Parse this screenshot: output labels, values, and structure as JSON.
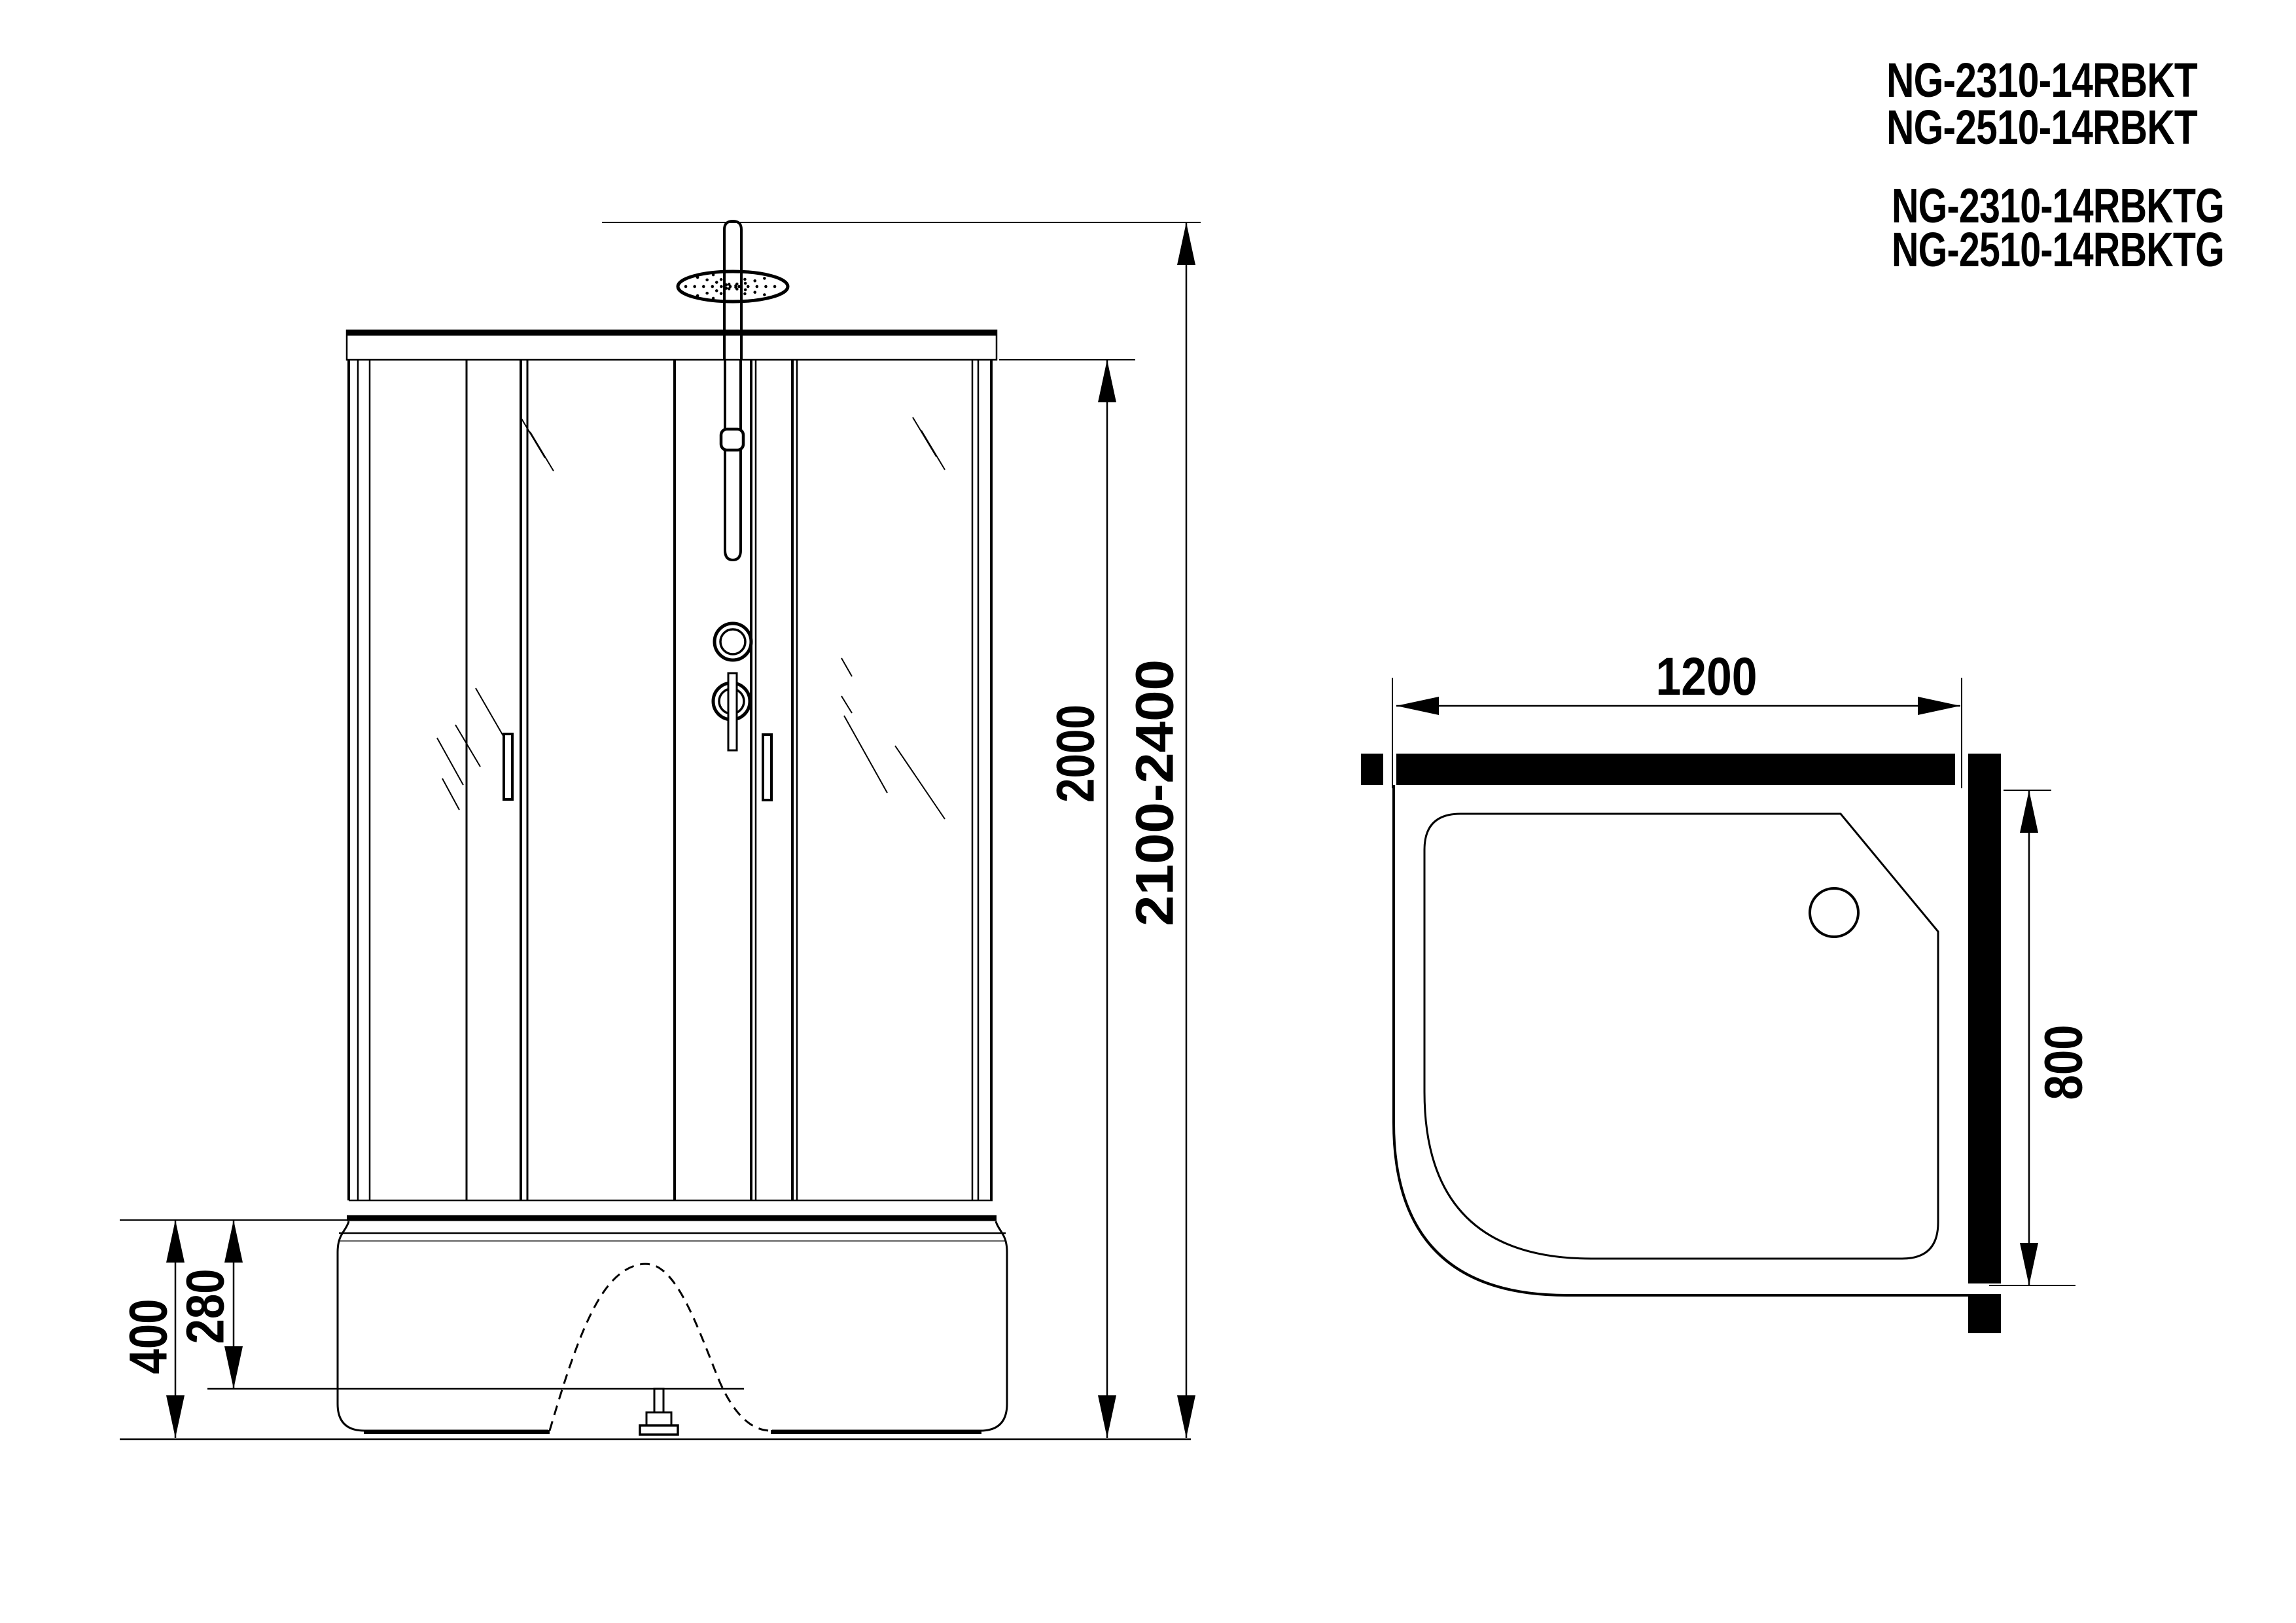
{
  "drawing": {
    "type": "technical-drawing",
    "background_color": "#ffffff",
    "line_color": "#000000",
    "views": [
      "front-elevation",
      "top-plan"
    ]
  },
  "title_block": {
    "model_1": "NG-2310-14RBKT",
    "model_2": "NG-2510-14RBKT",
    "model_3": "NG-2310-14RBKTG",
    "model_4": "NG-2510-14RBKTG"
  },
  "front_view": {
    "dim_cabin_height": "2000",
    "dim_total_height": "2100-2400",
    "dim_tray_height": "400",
    "dim_tray_inner_height": "280"
  },
  "top_view": {
    "dim_width": "1200",
    "dim_depth": "800"
  }
}
